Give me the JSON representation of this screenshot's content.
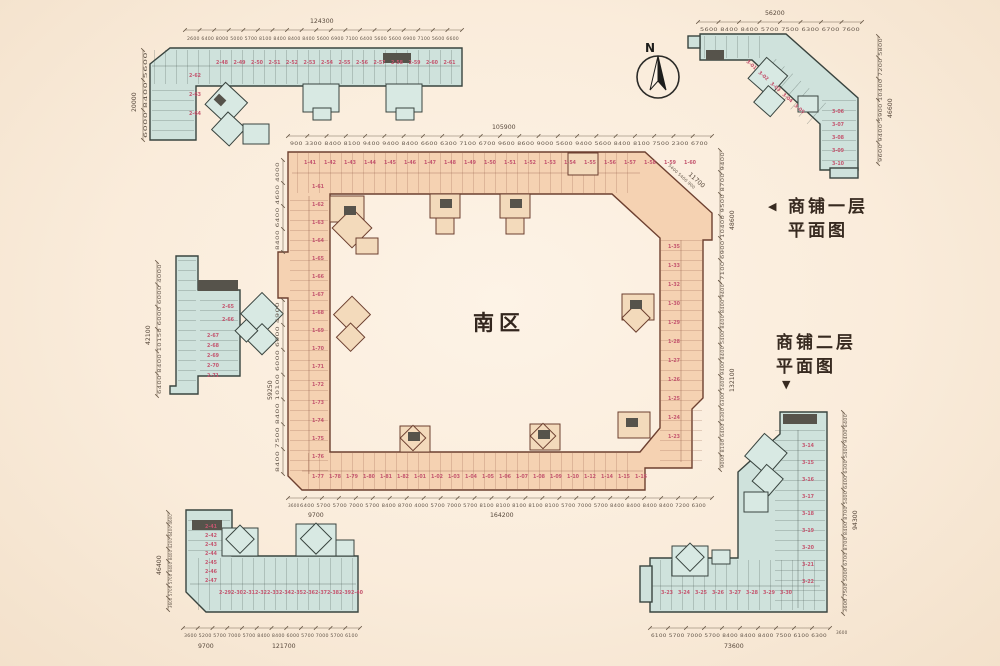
{
  "area_label": "南区",
  "legend": {
    "first_floor_line1": "商铺一层",
    "first_floor_line2": "平面图",
    "first_floor_arrow": "◀",
    "second_floor_line1": "商铺二层",
    "second_floor_line2": "平面图",
    "second_floor_arrow": "▼"
  },
  "north": {
    "label": "N"
  },
  "colors": {
    "background": "#faecdb",
    "shop_building_fill": "#cfe2dc",
    "shop_building_stroke": "#39443f",
    "main_building_fill": "#f5d2b2",
    "main_building_stroke": "#6d4030",
    "unit_number_pink": "#c4566f",
    "dimension_text": "#63564a",
    "label_dark": "#33261e"
  },
  "dimensions": {
    "ring_top": {
      "total": "105900",
      "segments": "900 3300 8400 8100 9400 9400 8400 6600 6300 7100 6700 9600 8600 9000 5600 9400 5600 8400 8100 7500 2300 6700"
    },
    "ring_bottom": {
      "total": "164200",
      "sub_left": "3600",
      "sub_mid": "9700",
      "segments": "6400 5700 5700 7000 5700 8400 8700 4000 5700 7000 5700 8100 8100 8100 8100 8100 5700 7000 5700 8400 8400 8400 8400 7200 6300"
    },
    "ring_right_upper": {
      "total": "48600",
      "segments": "7100 6900 10400 9500 8700 9400"
    },
    "ring_right_lower": {
      "total": "132100",
      "segments": "9000 8100 6400 6300 6300 5400 9400 8400 5400 8400 8400 9400"
    },
    "ring_left": {
      "total": "59250",
      "segments": "8400 7500 8400 10100 6000 6000 4900"
    },
    "ring_left_upper": {
      "total": "",
      "segments": "8400 6400 4600 4000"
    },
    "ring_diag": {
      "total": "11700",
      "segments": "5400 5400 900"
    },
    "top_building_top": {
      "total": "124300",
      "segments": "2600 6400 8000 5000 5700 8100 8400 8400 8400 5600 6900 7100 6400 5600 5600 6900 7100 5600 6600"
    },
    "top_building_left": {
      "total": "20000",
      "segments": "6000 8400 5600"
    },
    "top_right_top": {
      "total": "56200",
      "segments": "5600 8400 8400 5700 7500 6300 6700 7600"
    },
    "top_right_right": {
      "total": "46600",
      "segments": "9600 9400 5900 10400 7200 5800"
    },
    "left_building_left": {
      "total": "42100",
      "segments": "6400 8400 10150 6000 6000 4000"
    },
    "bottom_left_bottom": {
      "total": "121700",
      "sub_left": "9700",
      "segments": "3600 5200 5700 7000 5700 8400 8400 6000 5700 7000 5700 6100"
    },
    "bottom_left_left": {
      "total": "46400",
      "segments": "3600 5700 5700 8400 8400 4200 6400 4600"
    },
    "bottom_right_bottom": {
      "total": "73600",
      "sub_right": "3600",
      "segments": "6100 5700 7000 5700 8400 8400 8400 7500 6100 6300"
    },
    "bottom_right_right": {
      "total": "94300",
      "segments": "3600 7500 5000 6700 8700 8400 8700 5400 6400 6300 5400 9400 6400"
    }
  },
  "units": {
    "ring_top_row": [
      "1-41",
      "1-42",
      "1-43",
      "1-44",
      "1-45",
      "1-46",
      "1-47",
      "1-48",
      "1-49",
      "1-50",
      "1-51",
      "1-52",
      "1-53",
      "1-54",
      "1-55",
      "1-56",
      "1-57",
      "1-58",
      "1-59",
      "1-60"
    ],
    "ring_left_col": [
      "1-61",
      "1-62",
      "1-63",
      "1-64",
      "1-65",
      "1-66",
      "1-67",
      "1-68",
      "1-69",
      "1-70",
      "1-71",
      "1-72",
      "1-73",
      "1-74",
      "1-75",
      "1-76"
    ],
    "ring_right_col": [
      "1-35",
      "1-33",
      "1-32",
      "1-30",
      "1-29",
      "1-28",
      "1-27",
      "1-26",
      "1-25",
      "1-24",
      "1-23"
    ],
    "ring_bottom_row": [
      "1-77",
      "1-78",
      "1-79",
      "1-80",
      "1-81",
      "1-82",
      "1-01",
      "1-02",
      "1-03",
      "1-04",
      "1-05",
      "1-06",
      "1-07",
      "1-08",
      "1-09",
      "1-10",
      "1-12",
      "1-14",
      "1-15",
      "1-16"
    ],
    "top_building_row": [
      "2-48",
      "2-49",
      "2-50",
      "2-51",
      "2-52",
      "2-53",
      "2-54",
      "2-55",
      "2-56",
      "2-57",
      "2-58",
      "2-59",
      "2-60",
      "2-61"
    ],
    "top_building_col": [
      "2-62",
      "2-63",
      "2-64"
    ],
    "top_right_diag": [
      "3-01",
      "3-02",
      "3-03",
      "3-04",
      "3-05"
    ],
    "top_right_col": [
      "3-06",
      "3-07",
      "3-08",
      "3-09",
      "3-10"
    ],
    "left_mid_pair": [
      "2-65",
      "2-66"
    ],
    "left_mid_col": [
      "2-67",
      "2-68",
      "2-69",
      "2-70",
      "2-71"
    ],
    "bottom_left_col": [
      "2-41",
      "2-42",
      "2-43",
      "2-44",
      "2-45",
      "2-46",
      "2-47"
    ],
    "bottom_left_row": [
      "2-29",
      "2-30",
      "2-31",
      "2-32",
      "2-33",
      "2-34",
      "2-35",
      "2-36",
      "2-37",
      "2-38",
      "2-39",
      "2-40"
    ],
    "bottom_right_col": [
      "3-14",
      "3-15",
      "3-16",
      "3-17",
      "3-18",
      "3-19",
      "3-20",
      "3-21",
      "3-22"
    ],
    "bottom_right_row": [
      "3-23",
      "3-24",
      "3-25",
      "3-26",
      "3-27",
      "3-28",
      "3-29",
      "3-30"
    ]
  }
}
